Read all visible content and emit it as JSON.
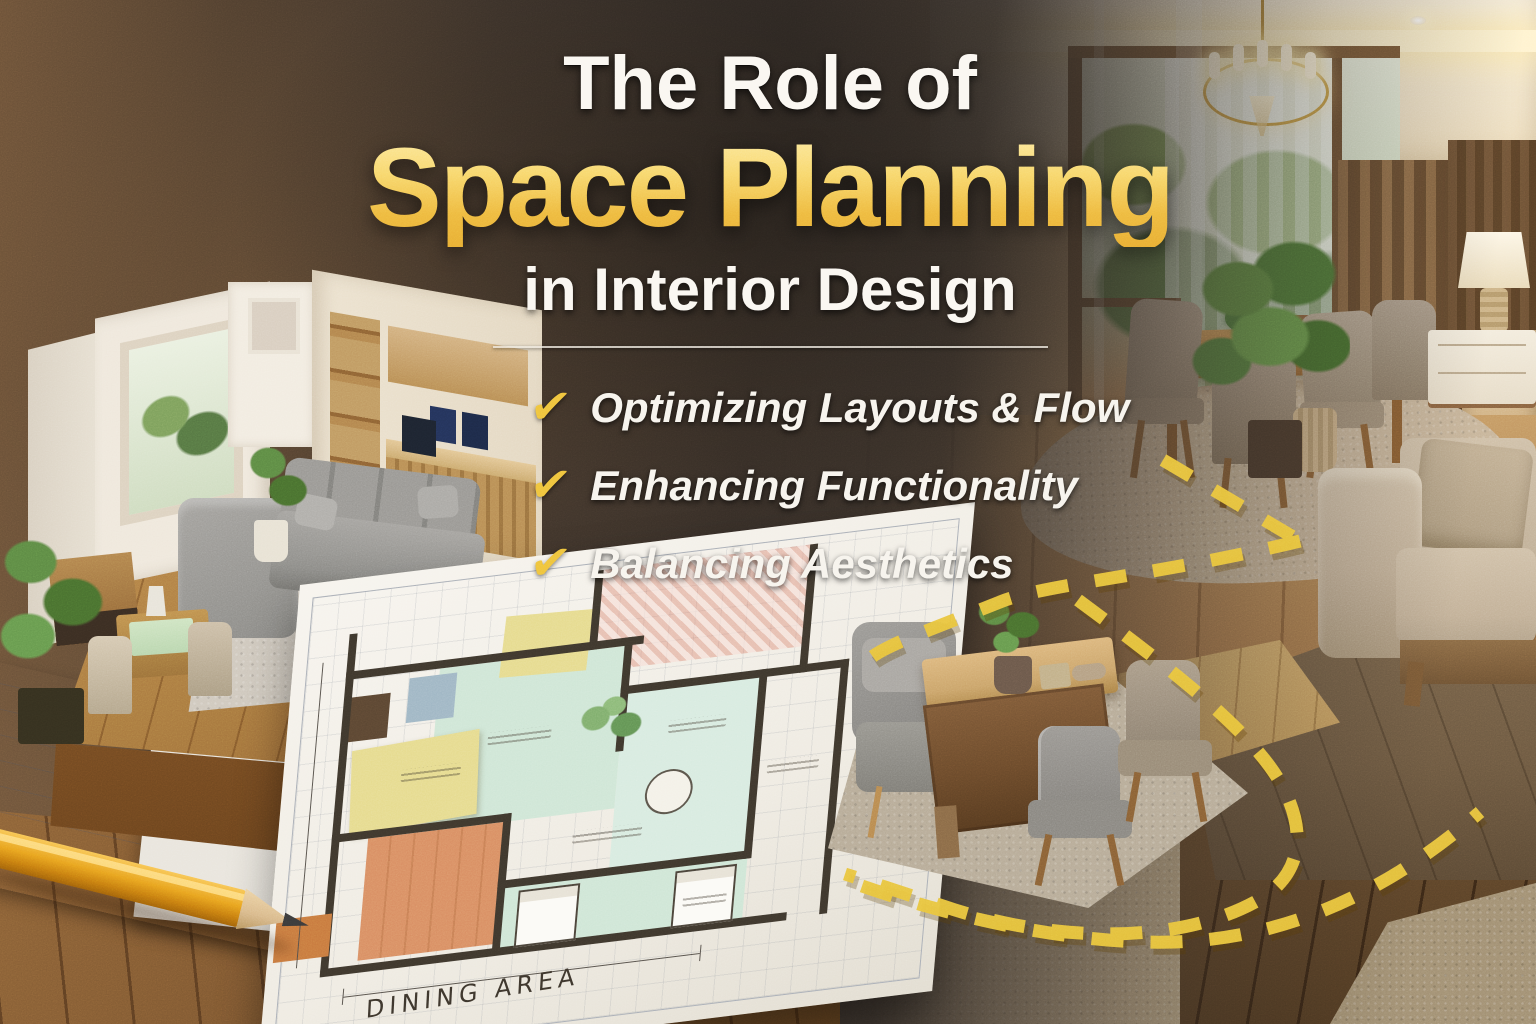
{
  "header": {
    "title_line1": "The Role of",
    "title_line2": "Space Planning",
    "title_line3": "in Interior Design"
  },
  "checklist": {
    "items": [
      {
        "icon": "check-icon",
        "label": "Optimizing Layouts & Flow"
      },
      {
        "icon": "check-icon",
        "label": "Enhancing Functionality"
      },
      {
        "icon": "check-icon",
        "label": "Balancing Aesthetics"
      }
    ]
  },
  "floor_plan": {
    "dining_label": "DINING AREA"
  },
  "colors": {
    "accent_gold": "#f2c24a",
    "gold_gradient_top": "#fdeba2",
    "gold_gradient_bottom": "#e8ad33",
    "headline_white": "#faf7f1",
    "check_yellow": "#efc33c",
    "background_dark": "#332b26",
    "background_brown": "#6b5138",
    "flow_dash_yellow": "#e9c43d",
    "plan_mint": "#cfe6d6",
    "plan_peach": "#d98e63",
    "plan_yellow": "#e6db8e",
    "wood_warm": "#a97e4f"
  },
  "objects": [
    "living-room-cutaway-model",
    "floor-plan-sheet",
    "pencil",
    "flow-path-dashes",
    "dining-room-photo",
    "meeting-desk-vignette"
  ]
}
